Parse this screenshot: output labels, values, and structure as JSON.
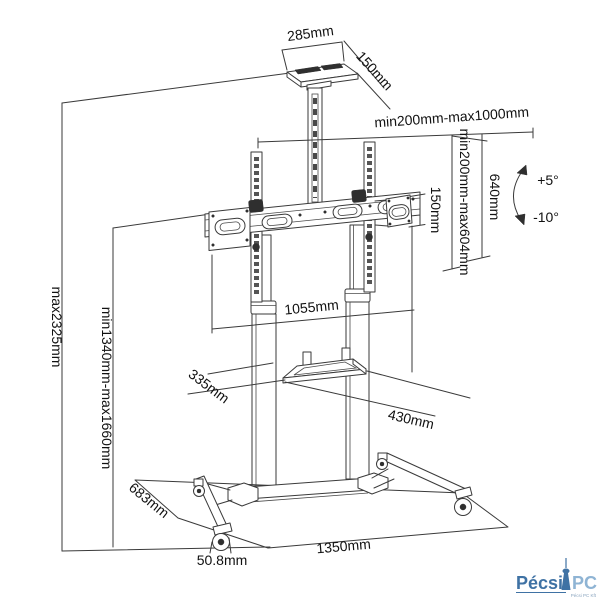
{
  "drawing": {
    "subject": "mobile-tv-floor-stand-technical-drawing",
    "colors": {
      "background": "#ffffff",
      "line": "#3a3a3a",
      "text": "#111111",
      "dark_fill": "#2f2f2f",
      "logo_primary": "#3f72a4",
      "logo_secondary": "#8fb4d4",
      "logo_tagline": "#8aa5bf"
    },
    "dims": {
      "shelf_width": "285mm",
      "shelf_depth": "150mm",
      "tv_mount_width_range": "min200mm-max1000mm",
      "vesa_height_range": "min200mm-max604mm",
      "bracket_height": "640mm",
      "side_plate_height": "150mm",
      "tilt_up": "+5°",
      "tilt_down": "-10°",
      "bar_length": "1055mm",
      "tray_depth": "335mm",
      "tray_width": "430mm",
      "overall_height": "max2325mm",
      "mount_height_range": "min1340mm-max1660mm",
      "base_depth": "683mm",
      "base_width": "1350mm",
      "caster_diameter": "50.8mm"
    },
    "logo": {
      "primary": "Pécsi",
      "secondary": "PC",
      "tagline": "Pécsi PC Kft"
    }
  }
}
